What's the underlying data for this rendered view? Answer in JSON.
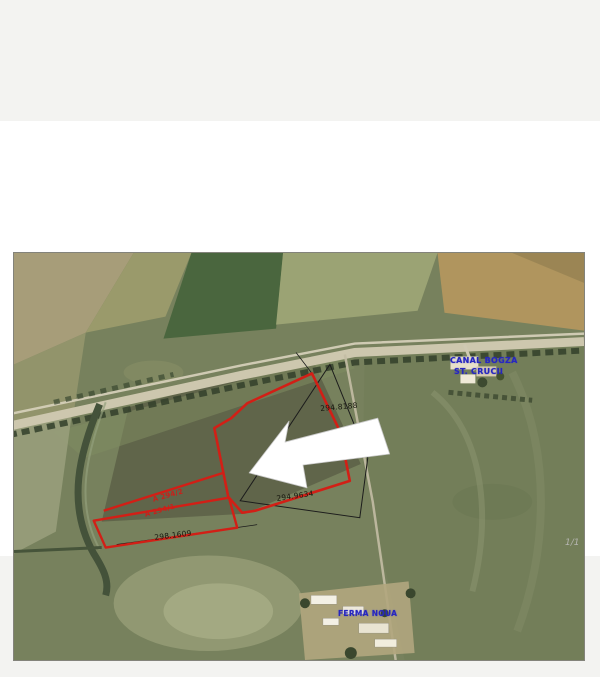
{
  "window": {
    "background": "#f3f3f1",
    "panel_background": "#ffffff",
    "pager": "1/1"
  },
  "map": {
    "type": "aerial-photo-cadastral-sketch",
    "border_color": "#83837b",
    "annotations": {
      "measure_top": "294.8188",
      "measure_mid": "294.9634",
      "measure_bottom": "298.1609",
      "parcel_label_line1": "A 294/2",
      "parcel_label_line2": "A 294/1",
      "poi_top_line1": "CANAL BOGZA",
      "poi_top_line2": "ST. CRUCII",
      "poi_bottom": "FERMA NOUA"
    },
    "colors": {
      "parcel_outline": "#d21f16",
      "cadastral_line": "#1c1c1c",
      "poi_text": "#2626bf",
      "measure_text": "#17170f",
      "arrow_fill": "#ffffff",
      "arrow_stroke": "#c9c9c9"
    }
  }
}
